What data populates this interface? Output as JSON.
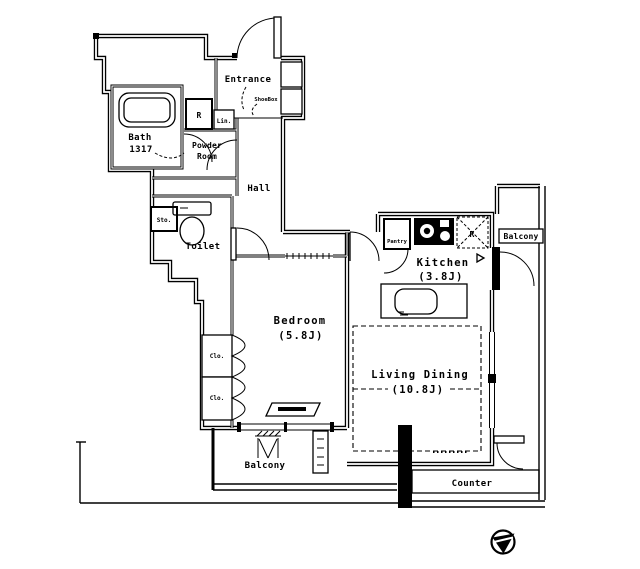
{
  "floorplan": {
    "background": "#ffffff",
    "line_color": "#000000",
    "rooms": {
      "entrance": {
        "label": "Entrance"
      },
      "shoebox": {
        "label": "ShoeBox"
      },
      "bath": {
        "label": "Bath",
        "size": "1317"
      },
      "washing_machine": {
        "label": "R"
      },
      "linen": {
        "label": "Lin."
      },
      "powder_room": {
        "line1": "Powder",
        "line2": "Room"
      },
      "hall": {
        "label": "Hall"
      },
      "storage": {
        "label": "Sto."
      },
      "toilet": {
        "label": "Toilet"
      },
      "bedroom": {
        "label": "Bedroom",
        "size": "(5.8J)"
      },
      "closet_upper": {
        "label": "Clo."
      },
      "closet_lower": {
        "label": "Clo."
      },
      "kitchen": {
        "label": "Kitchen",
        "size": "(3.8J)"
      },
      "pantry": {
        "label": "Pantry"
      },
      "refrigerator": {
        "label": "R"
      },
      "living_dining": {
        "label": "Living Dining",
        "size": "(10.8J)"
      },
      "balcony_right": {
        "label": "Balcony"
      },
      "balcony_bottom": {
        "label": "Balcony"
      },
      "counter": {
        "label": "Counter"
      }
    }
  }
}
